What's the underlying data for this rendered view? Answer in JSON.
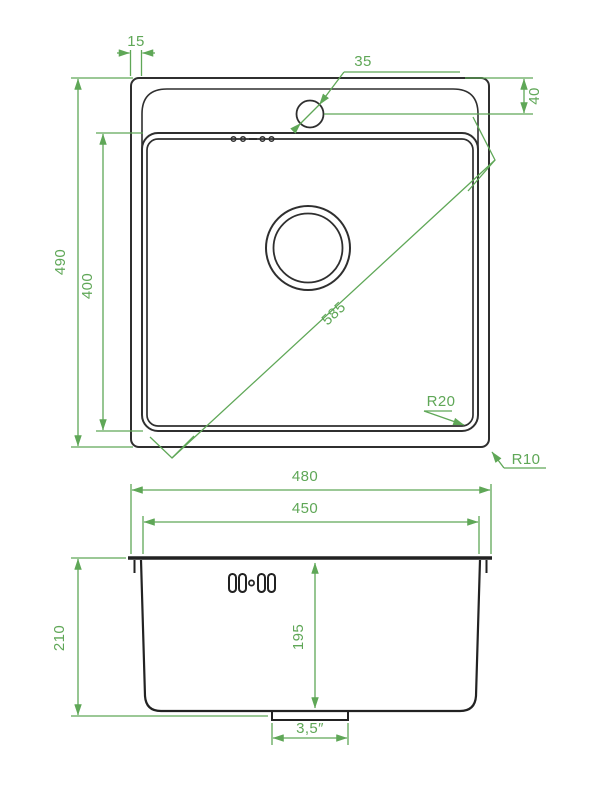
{
  "title": "Kitchen sink technical drawing (top view and front section)",
  "colors": {
    "background": "#ffffff",
    "outline": "#2f2f2f",
    "dimension": "#5fa757"
  },
  "top_view": {
    "dimensions": {
      "rim_width": "15",
      "faucet_hole_diameter": "35",
      "faucet_hole_offset": "40",
      "overall_depth": "490",
      "bowl_depth": "400",
      "bowl_diagonal": "585",
      "bowl_corner_radius": "R20",
      "outer_corner_radius": "R10"
    }
  },
  "side_view": {
    "dimensions": {
      "overall_width": "480",
      "bowl_top_width": "450",
      "overall_height": "210",
      "bowl_inner_depth": "195",
      "drain_size": "3,5″"
    }
  }
}
